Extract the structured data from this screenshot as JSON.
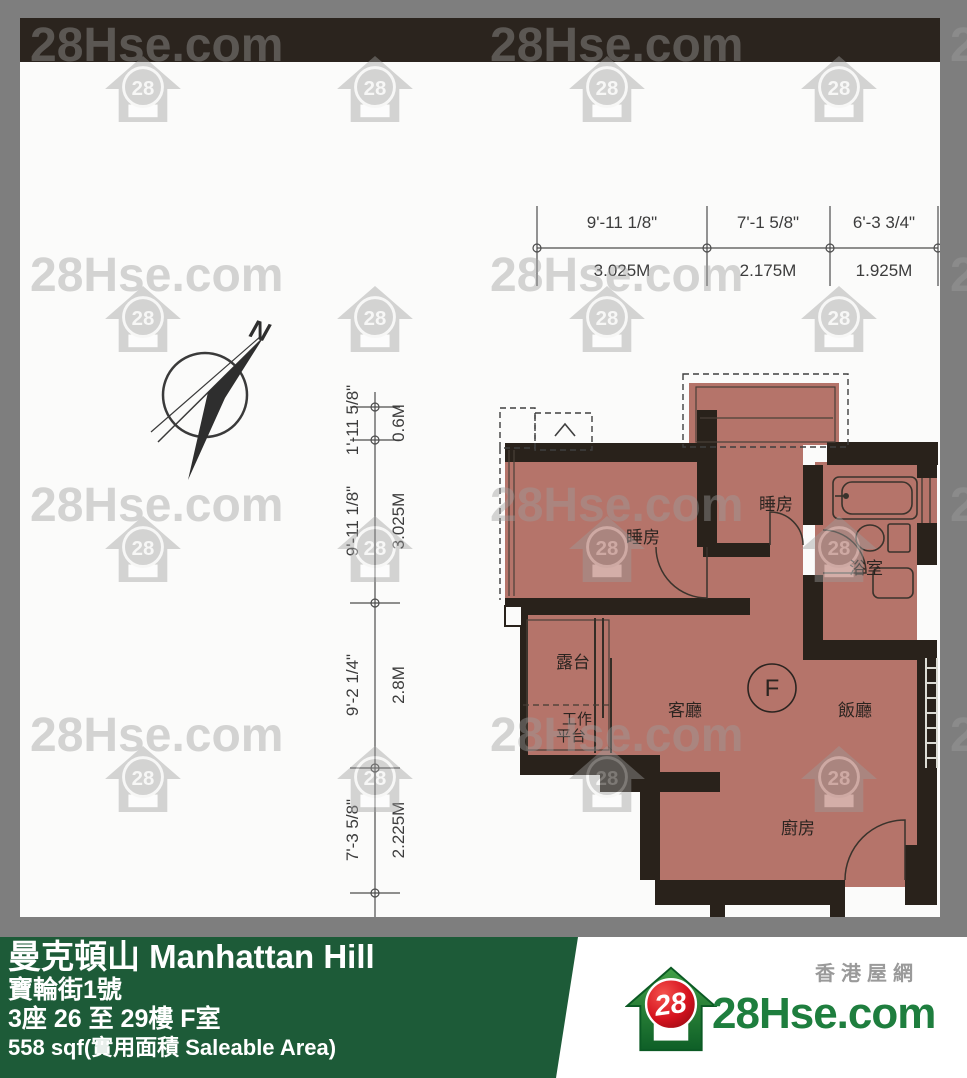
{
  "watermark": {
    "text": "28Hse.com",
    "house_badge": "28"
  },
  "top_dimensions": {
    "segments": [
      {
        "imperial": "9'-11 1/8\"",
        "metric": "3.025M"
      },
      {
        "imperial": "7'-1 5/8\"",
        "metric": "2.175M"
      },
      {
        "imperial": "6'-3 3/4\"",
        "metric": "1.925M"
      }
    ]
  },
  "left_dimensions": {
    "segments": [
      {
        "imperial": "1'-11 5/8\"",
        "metric": "0.6M"
      },
      {
        "imperial": "9'-11 1/8\"",
        "metric": "3.025M"
      },
      {
        "imperial": "9'-2 1/4\"",
        "metric": "2.8M"
      },
      {
        "imperial": "7'-3 5/8\"",
        "metric": "2.225M"
      }
    ]
  },
  "compass": {
    "north_label": "N"
  },
  "rooms": {
    "bedroom_main": "睡房",
    "bedroom_left": "睡房",
    "bathroom": "浴室",
    "living": "客廳",
    "dining": "飯廳",
    "kitchen": "廚房",
    "balcony": "露台",
    "utility_line1": "工作",
    "utility_line2": "平台",
    "unit_label": "F"
  },
  "colors": {
    "floor": "#b5746a",
    "wall": "#29221b",
    "footer_green": "#1d5b38",
    "logo_green": "#1e7e3e"
  },
  "footer": {
    "estate_name": "曼克頓山 Manhattan Hill",
    "address": "寶輪街1號",
    "unit_info": "3座 26 至 29樓 F室",
    "area_info": "558 sqf(實用面積 Saleable Area)"
  },
  "logo": {
    "site_name_cn": "香港屋網",
    "site_name": "28Hse.com",
    "badge": "28"
  }
}
